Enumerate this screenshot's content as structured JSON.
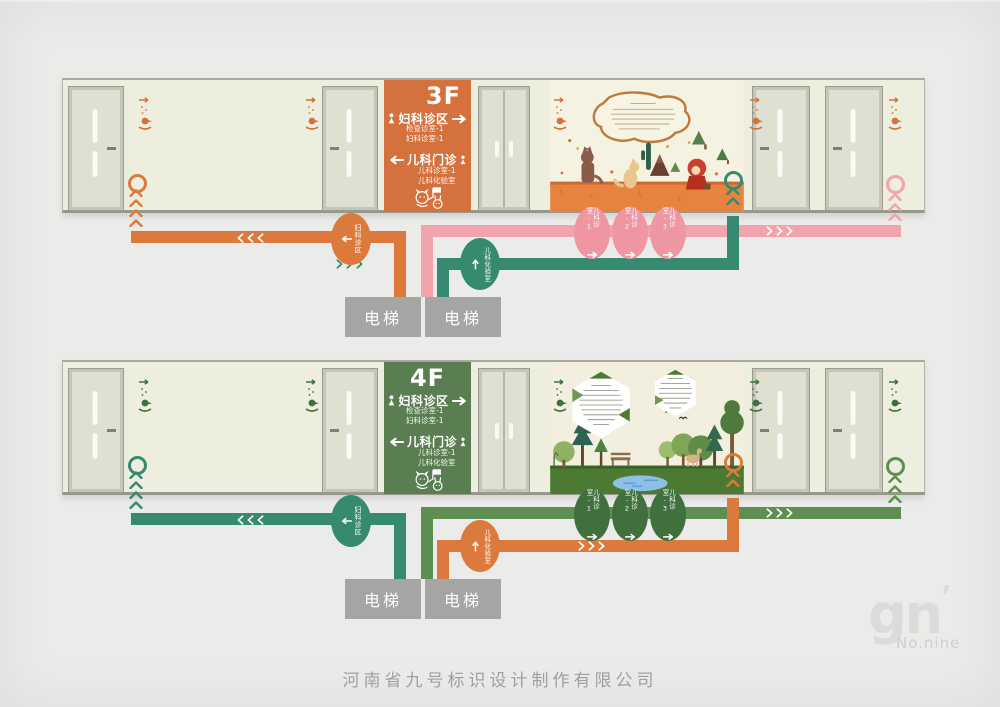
{
  "floors": [
    {
      "id": "3f",
      "label": "3F",
      "sign": {
        "dept_top": "妇科诊区",
        "dept_top_rooms": [
          "检查诊室-1",
          "妇科诊室-1"
        ],
        "dept_bottom": "儿科门诊",
        "dept_bottom_rooms": [
          "儿科诊室-1",
          "儿科化验室"
        ]
      },
      "flow": {
        "node_main": "妇科诊区",
        "node_mid": [
          "儿科诊室-1",
          "儿科诊室-2",
          "儿科诊室-3"
        ],
        "node_branch": "儿科化验室"
      },
      "elevators": [
        "电梯",
        "电梯"
      ]
    },
    {
      "id": "4f",
      "label": "4F",
      "sign": {
        "dept_top": "妇科诊区",
        "dept_top_rooms": [
          "检查诊室-1",
          "妇科诊室-1"
        ],
        "dept_bottom": "儿科门诊",
        "dept_bottom_rooms": [
          "儿科诊室-1",
          "儿科化验室"
        ]
      },
      "flow": {
        "node_main": "妇科诊区",
        "node_mid": [
          "儿科诊室-1",
          "儿科诊室-2",
          "儿科诊室-3"
        ],
        "node_branch": "儿科化验室"
      },
      "elevators": [
        "电梯",
        "电梯"
      ]
    }
  ],
  "footer": {
    "company": "河南省九号标识设计制作有限公司"
  },
  "logo": {
    "mark": "gn",
    "sub": "No.nine"
  },
  "colors": {
    "sign_orange": "#d4713d",
    "flow_orange": "#dc7a3e",
    "flow_pink": "#f2a3ac",
    "flow_teal": "#368a6f",
    "sign_green": "#5a7e52",
    "flow_green": "#5e8e52",
    "flow_green_dark": "#3f703e",
    "elevator_gray": "#a5a5a3",
    "wall_cream": "#edeedd"
  }
}
